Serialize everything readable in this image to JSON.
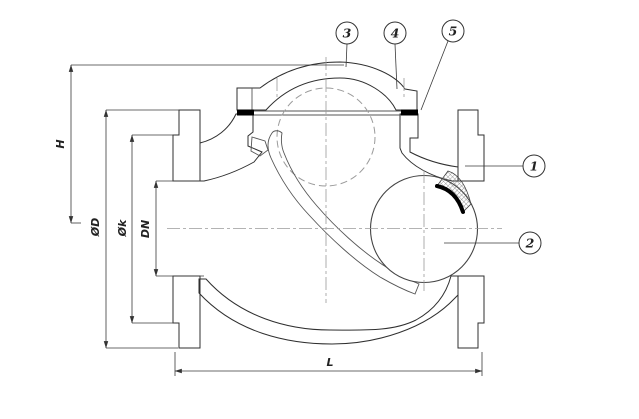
{
  "drawing": {
    "title": "swing-ball check valve cross-section",
    "dimensions": {
      "height_label": "H",
      "flange_od_label": "ØD",
      "bolt_circle_label": "Øk",
      "nominal_bore_label": "DN",
      "face_to_face_label": "L"
    },
    "balloons": [
      {
        "number": "1"
      },
      {
        "number": "2"
      },
      {
        "number": "3"
      },
      {
        "number": "4"
      },
      {
        "number": "5"
      }
    ],
    "colors": {
      "background": "#ffffff",
      "line": "#2f2f2f",
      "hatch": "#707070",
      "centerline": "#9a9a9a",
      "seal": "#000000"
    }
  }
}
